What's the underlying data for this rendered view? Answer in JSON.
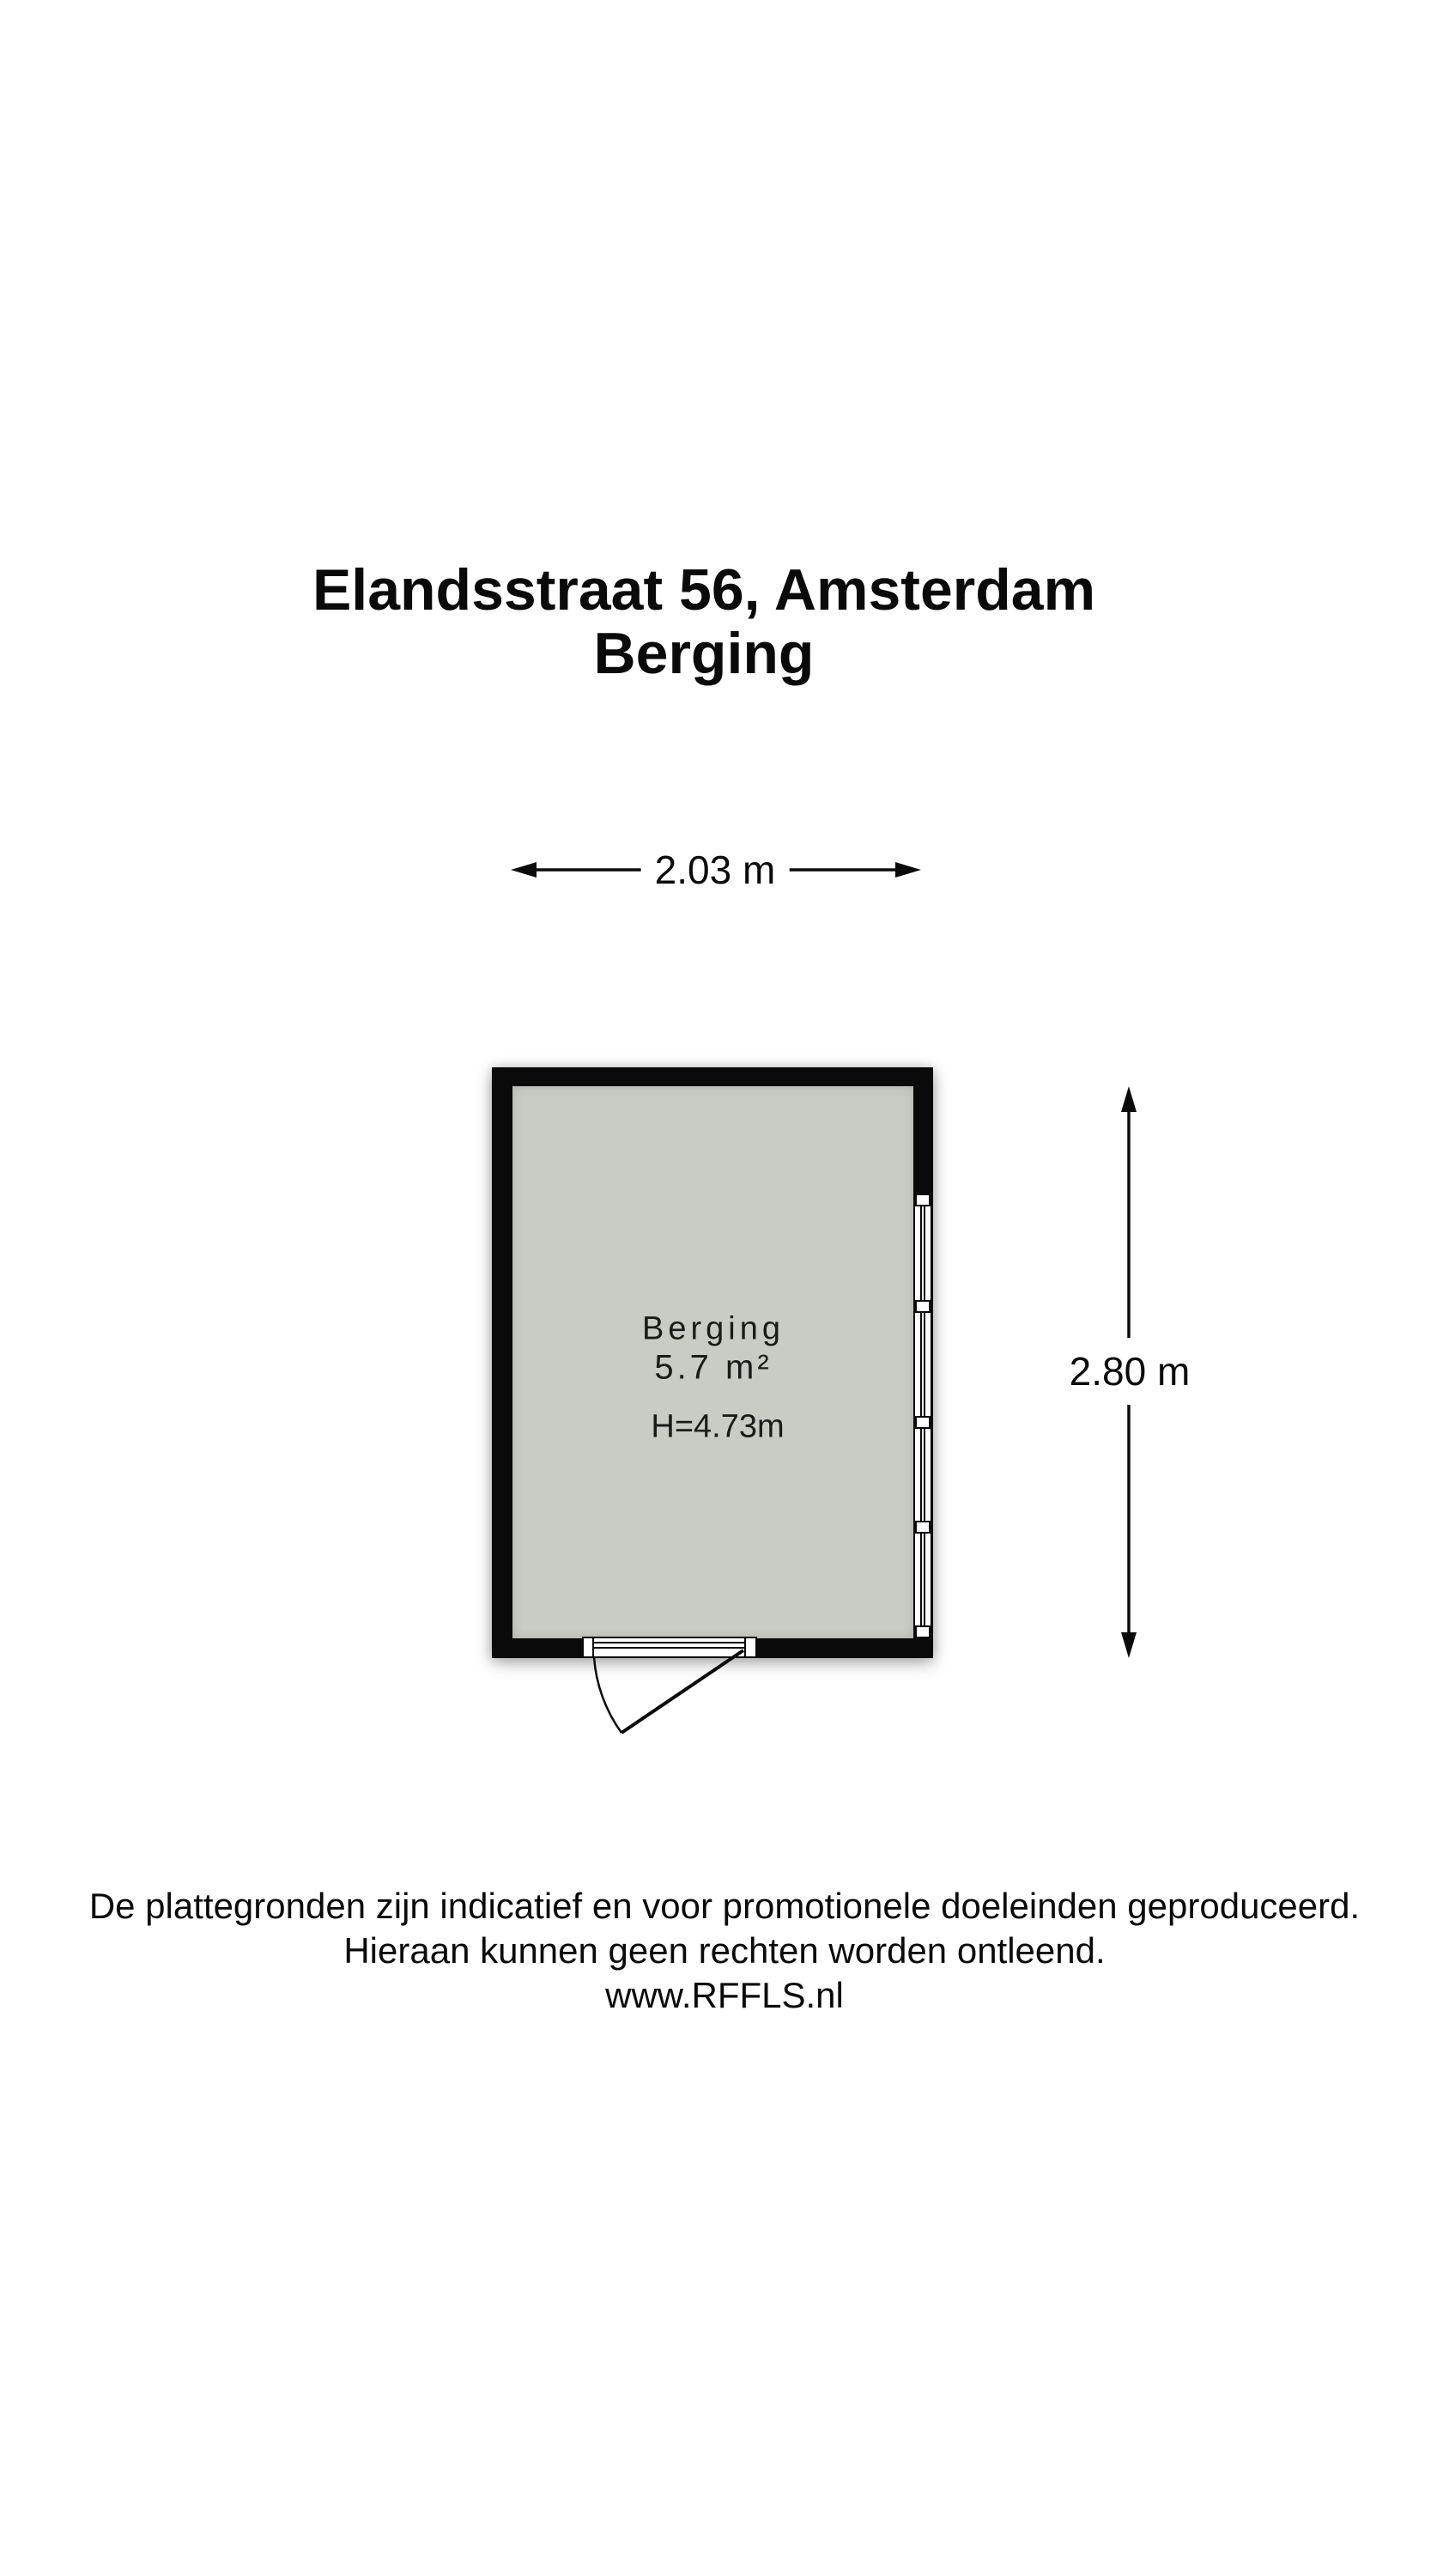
{
  "title": {
    "line1": "Elandsstraat 56, Amsterdam",
    "line2": "Berging"
  },
  "floor_plan": {
    "room": {
      "name": "Berging",
      "area": "5.7 m²",
      "ceiling_height": "H=4.73m"
    },
    "dimensions": {
      "width_label": "2.03 m",
      "height_label": "2.80 m"
    }
  },
  "footer": {
    "line1": "De plattegronden zijn indicatief en voor promotionele doeleinden geproduceerd.",
    "line2": "Hieraan kunnen geen rechten worden ontleend.",
    "line3": "www.RFFLS.nl"
  },
  "colors": {
    "wall": "#0a0a0a",
    "floor": "#c9ccc4",
    "background": "#ffffff",
    "text": "#111111"
  }
}
